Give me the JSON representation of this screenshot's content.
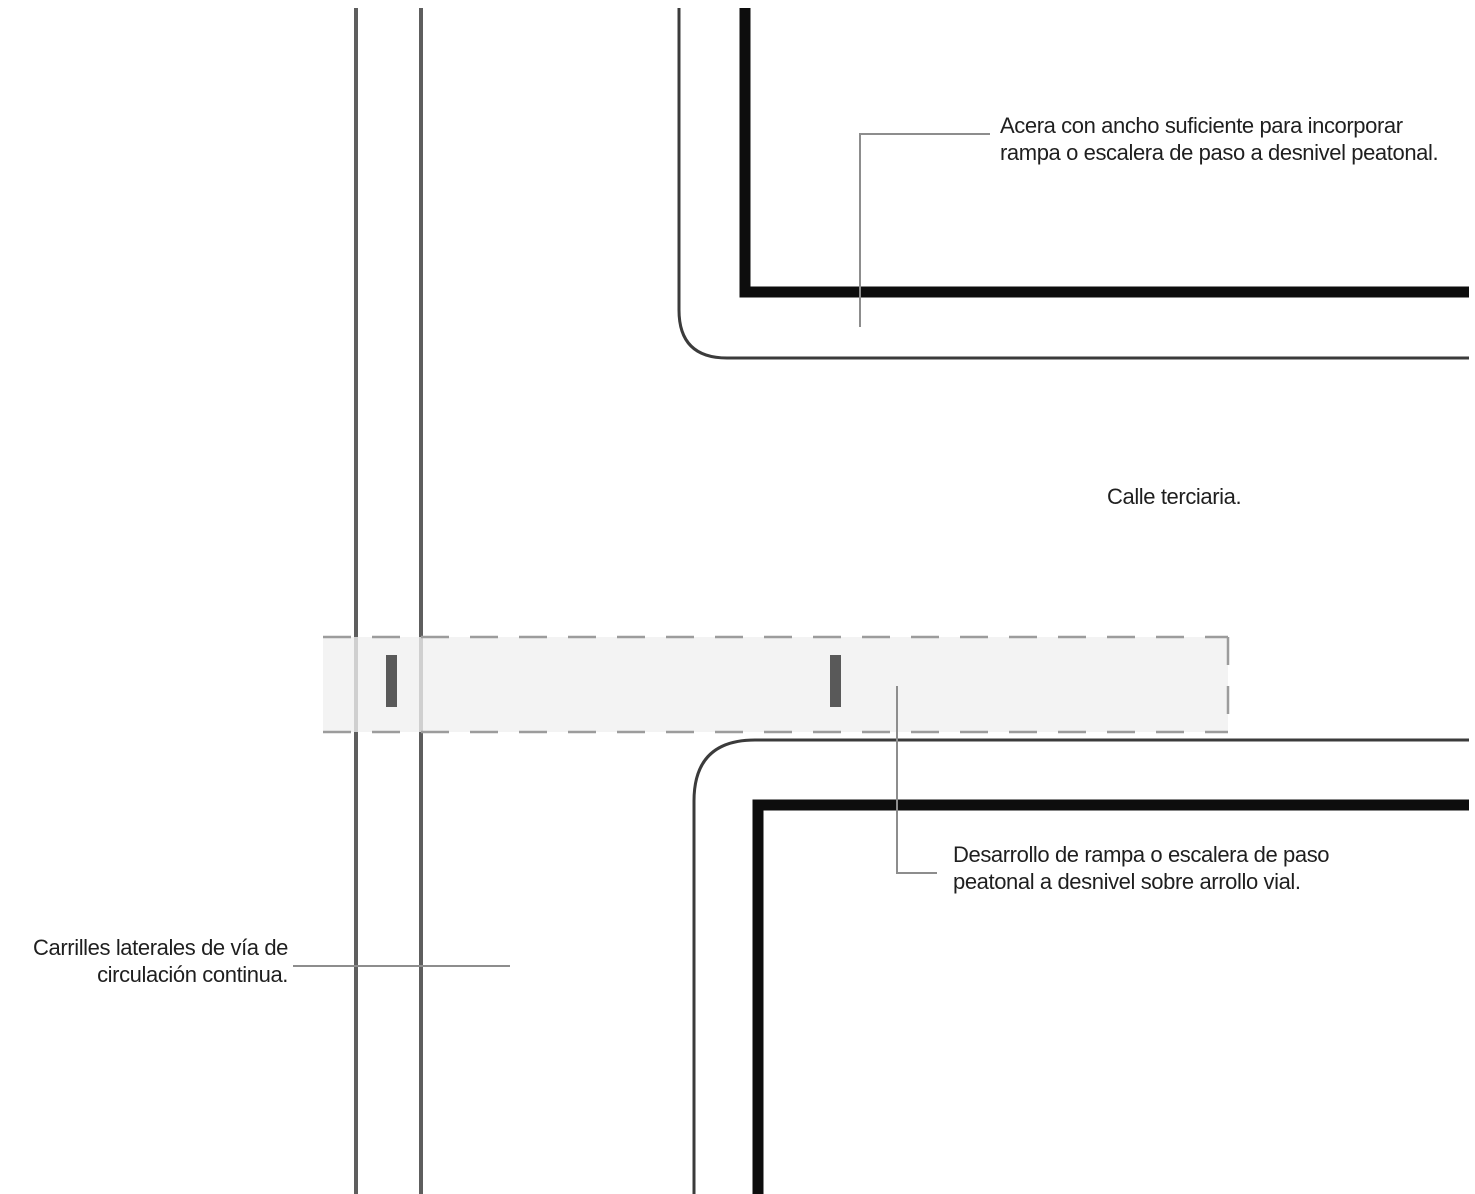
{
  "diagram": {
    "colors": {
      "background": "#ffffff",
      "curb_thin": "#3b3b3b",
      "curb_thick": "#0d0d0d",
      "lane_line": "#5e5e5e",
      "leader_line": "#8d8d8d",
      "crossing_fill": "#efefef",
      "crossing_border": "#9c9c9c",
      "crossing_tick": "#595959",
      "annotation_text": "#1f1f1f"
    },
    "labels": {
      "street_name": "Calle terciaria."
    },
    "annotations": {
      "sidewalk": {
        "line1": "Acera con ancho suficiente para incorporar",
        "line2": "rampa o escalera de paso a desnivel peatonal."
      },
      "ramp": {
        "line1": "Desarrollo de rampa o escalera de paso",
        "line2": "peatonal a desnivel sobre arrollo vial."
      },
      "lanes": {
        "line1": "Carrilles laterales de vía de",
        "line2": "circulación continua."
      }
    }
  }
}
